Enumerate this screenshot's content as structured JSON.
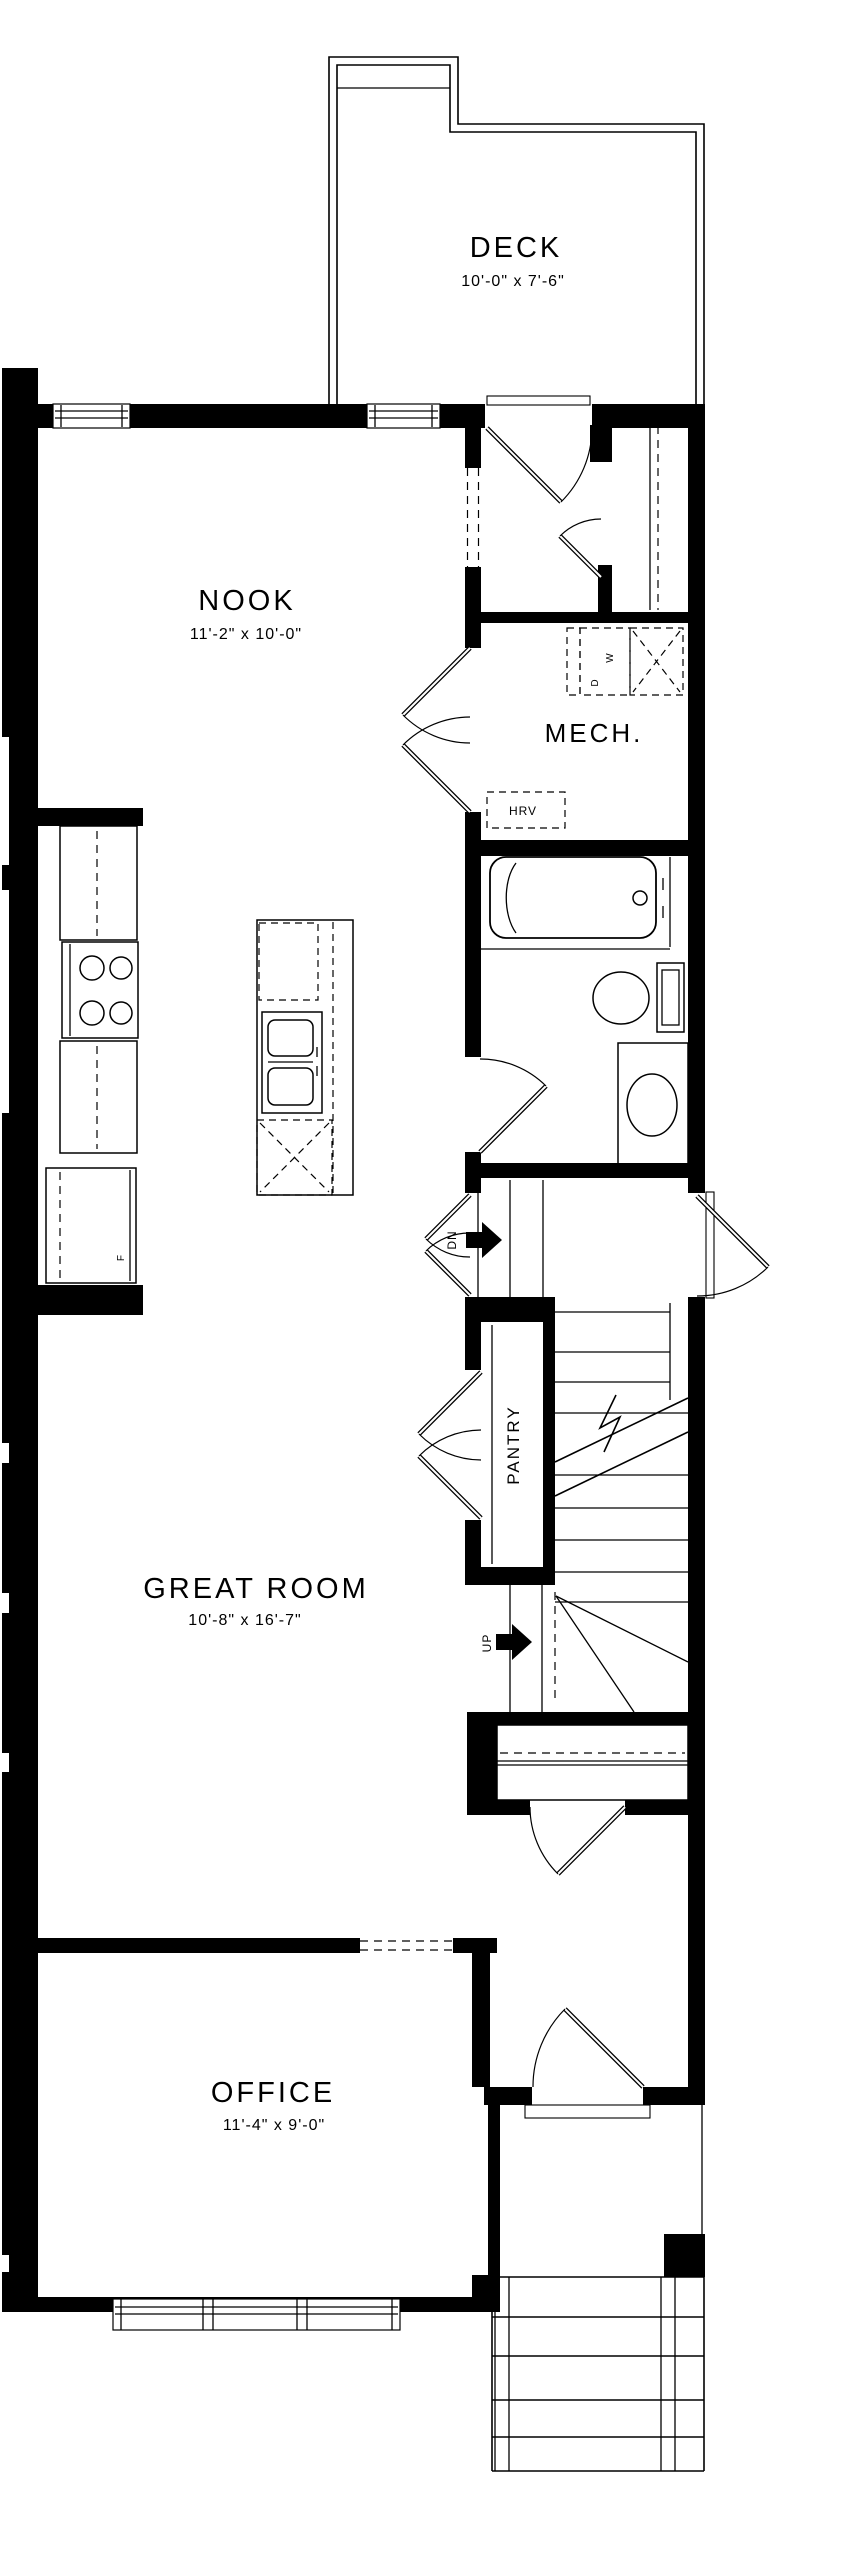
{
  "colors": {
    "line": "#000000",
    "background": "#ffffff"
  },
  "rooms": {
    "deck": {
      "label": "DECK",
      "dims": "10'-0\" x 7'-6\""
    },
    "nook": {
      "label": "NOOK",
      "dims": "11'-2\" x 10'-0\""
    },
    "mech": {
      "label": "MECH."
    },
    "pantry": {
      "label": "PANTRY"
    },
    "great_room": {
      "label": "GREAT ROOM",
      "dims": "10'-8\" x 16'-7\""
    },
    "office": {
      "label": "OFFICE",
      "dims": "11'-4\" x 9'-0\""
    }
  },
  "stairs": {
    "down_label": "DN",
    "up_label": "UP"
  },
  "appliances": {
    "fridge_label": "F",
    "hrv_label": "HRV",
    "washer_label": "W",
    "dryer_label": "D"
  }
}
